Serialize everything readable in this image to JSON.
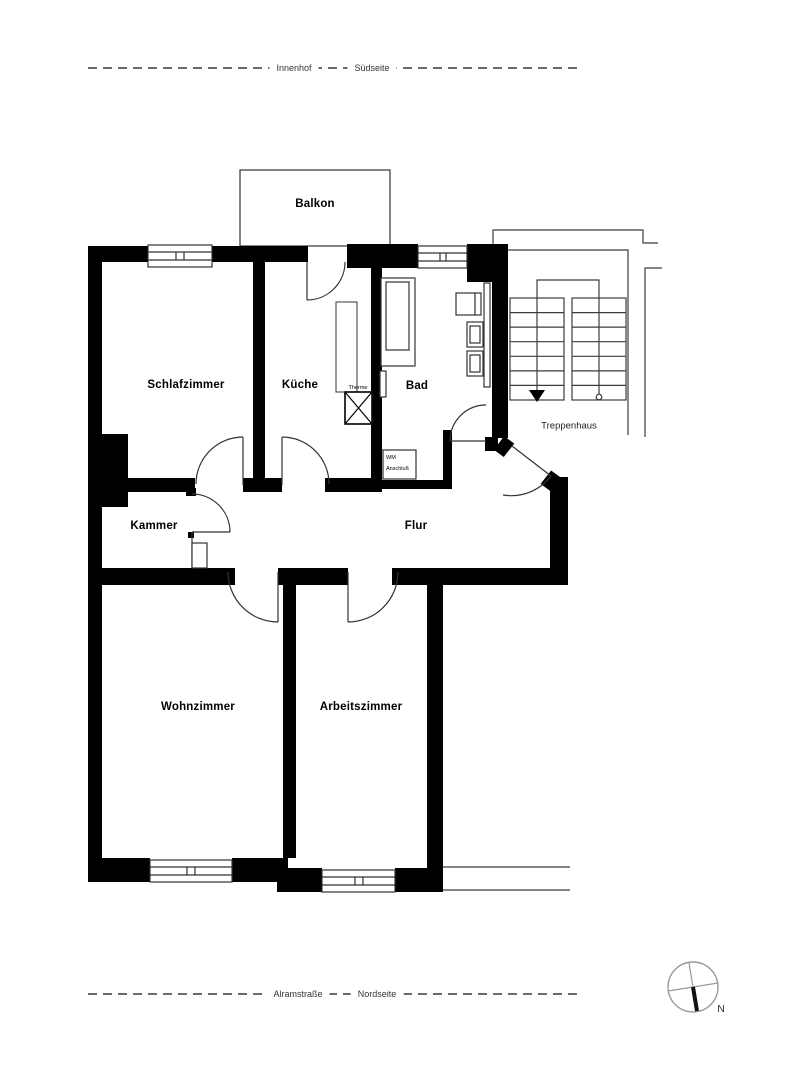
{
  "site": {
    "top_left": "Innenhof",
    "top_right": "Südseite",
    "bottom_left": "Alramstraße",
    "bottom_right": "Nordseite"
  },
  "rooms": {
    "balkon": "Balkon",
    "schlafzimmer": "Schlafzimmer",
    "kueche": "Küche",
    "bad": "Bad",
    "kammer": "Kammer",
    "flur": "Flur",
    "wohnzimmer": "Wohnzimmer",
    "arbeitszimmer": "Arbeitszimmer",
    "treppenhaus": "Treppenhaus"
  },
  "fixtures": {
    "therme": "Therme",
    "wm_line1": "WM",
    "wm_line2": "Anschluß"
  },
  "compass": {
    "north": "N"
  },
  "colors": {
    "wall": "#000000",
    "line": "#3c3c3c",
    "dashed": "#555555",
    "compass_ring": "#9a9a9a"
  }
}
